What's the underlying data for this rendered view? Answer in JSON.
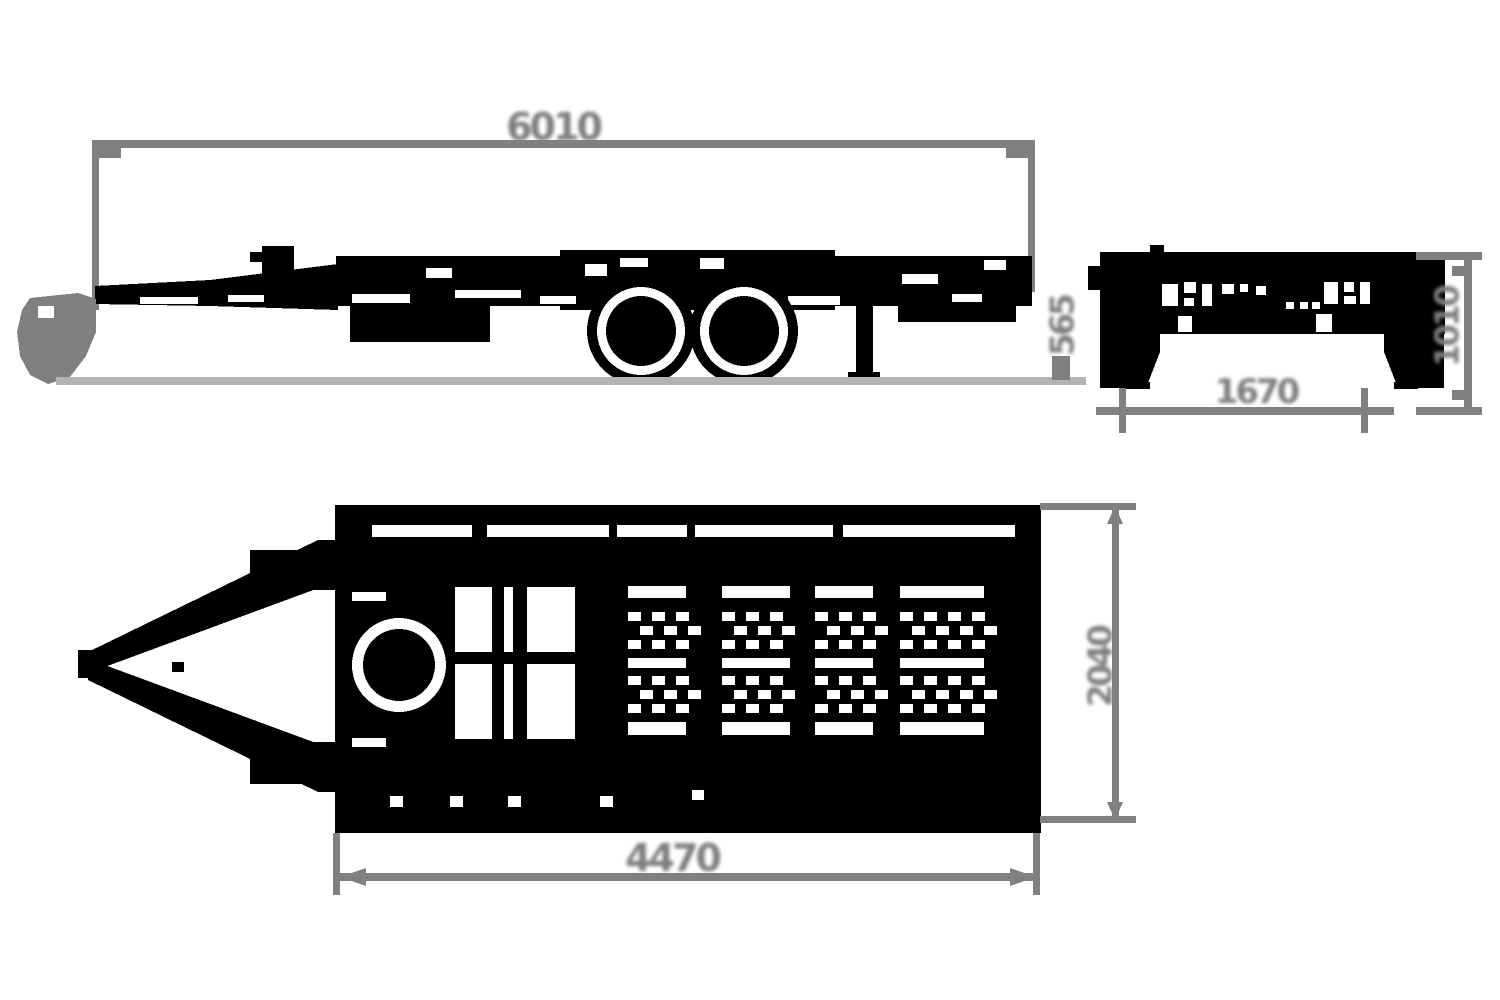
{
  "colors": {
    "outline": "#000000",
    "dimension_lines": "#808080",
    "ground_line": "#b3b3b3",
    "background": "#ffffff"
  },
  "dimensions": {
    "side_overall_length": "6010",
    "side_loading_height": "565",
    "rear_width": "1670",
    "rear_overall_height": "1010",
    "top_bed_length": "4470",
    "top_bed_width": "2040"
  }
}
